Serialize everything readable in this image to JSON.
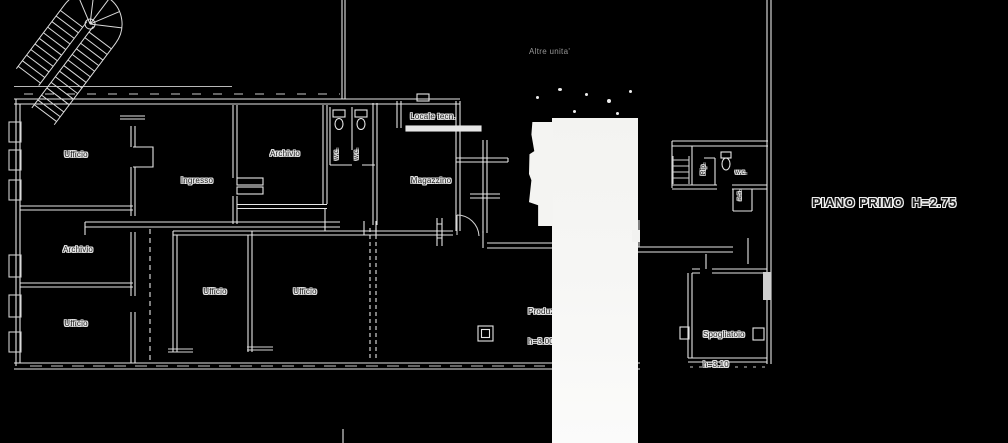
{
  "drawing": {
    "floor_title": "PIANO PRIMO  H=2.75",
    "external_note": "Altre unita'",
    "rooms": {
      "ufficio_top_left": "Ufficio",
      "ingresso": "Ingresso",
      "archivio_top": "Archivio",
      "wc_stall_left": "w.c.",
      "wc_stall_right": "w.c.",
      "locale_tecnico": "Locale tecn.",
      "magazzino": "Magazzino",
      "archivio_left": "Archivio",
      "ufficio_bottom_left": "Ufficio",
      "ufficio_mid_left": "Ufficio",
      "ufficio_mid_right": "Ufficio",
      "produzione_name": "Produzione",
      "produzione_height": "h=3.00",
      "ripostiglio": "Rip.",
      "wc_right": "w.c.",
      "as_small": "a.s.",
      "spogliatoio_name": "Spogliatoio",
      "spogliatoio_height": "h=3.10"
    },
    "colors": {
      "background": "#000000",
      "wall_line": "#e8e8e8",
      "detail_line": "#c8c8c8",
      "whiteout": "#f6f6f4",
      "label_ink": "#1f1f1f",
      "label_halo": "#e9e9e9",
      "note_gray": "#969696"
    }
  }
}
